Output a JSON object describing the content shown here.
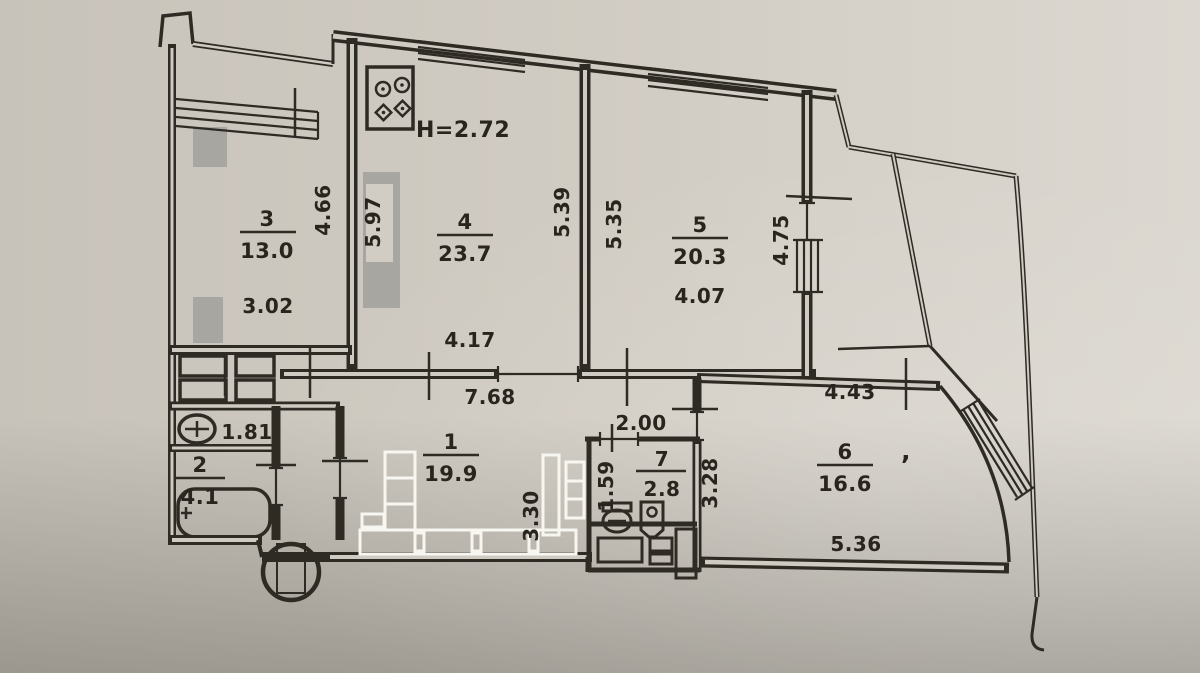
{
  "photo": {
    "paper_light": "#dbd7cf",
    "paper_mid": "#cdc8bf",
    "paper_dark": "#a39f97",
    "ink": "#2e2a24"
  },
  "plan": {
    "height_note": "H=2.72",
    "mark": "ʼ",
    "rooms": [
      {
        "num": "1",
        "area": "19.9"
      },
      {
        "num": "2",
        "area": "4.1"
      },
      {
        "num": "3",
        "area": "13.0"
      },
      {
        "num": "4",
        "area": "23.7"
      },
      {
        "num": "5",
        "area": "20.3"
      },
      {
        "num": "6",
        "area": "16.6"
      },
      {
        "num": "7",
        "area": "2.8"
      }
    ],
    "dims": {
      "r3w": "3.02",
      "r3h": "4.66",
      "w34": "5.97",
      "r4w": "4.17",
      "r4h": "5.39",
      "r5l": "5.35",
      "r5w": "4.07",
      "r5r": "4.75",
      "hallw": "7.68",
      "halld": "3.30",
      "wc": "1.81",
      "r7w": "2.00",
      "r7h": "1.59",
      "r6l": "3.28",
      "r6t": "4.43",
      "r6b": "5.36"
    }
  }
}
